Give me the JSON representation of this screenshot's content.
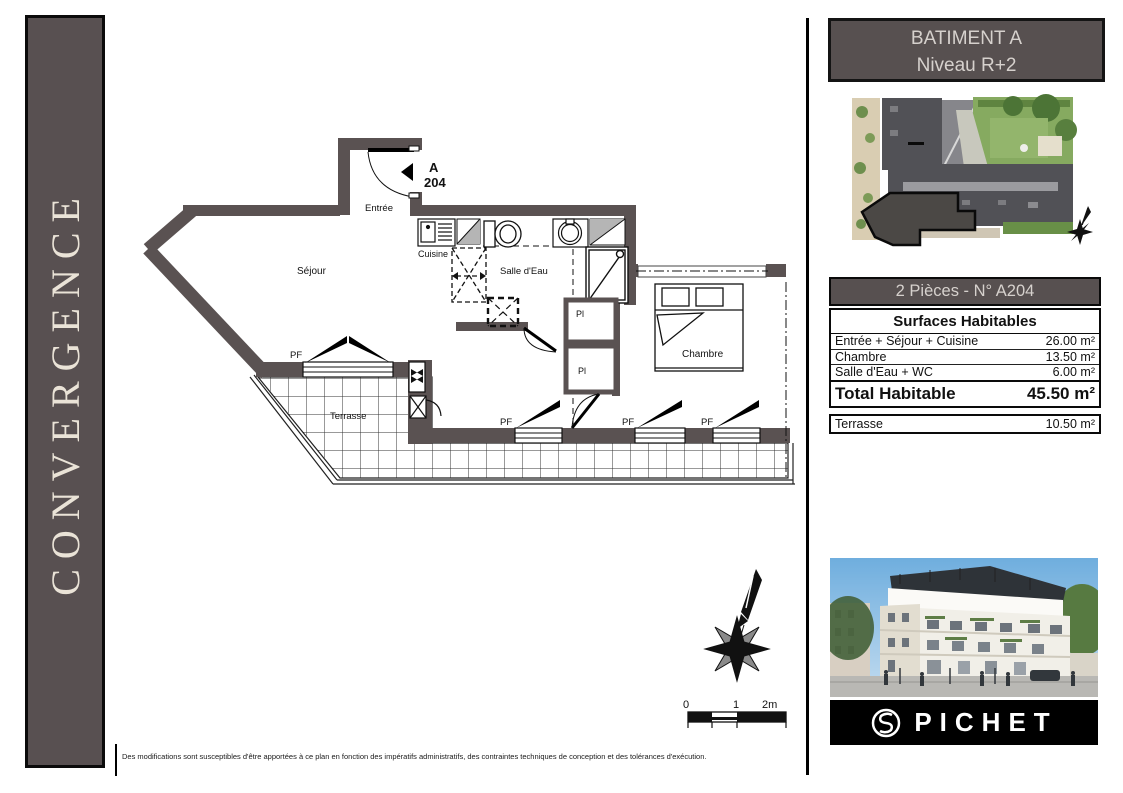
{
  "banner": {
    "project": "CONVERGENCE"
  },
  "header": {
    "line1": "BATIMENT A",
    "line2": "Niveau R+2"
  },
  "unit_table": {
    "title": "2 Pièces - N° A204",
    "subtitle": "Surfaces Habitables",
    "rows": [
      {
        "label": "Entrée + Séjour + Cuisine",
        "value": "26.00 m²"
      },
      {
        "label": "Chambre",
        "value": "13.50 m²"
      },
      {
        "label": "Salle d'Eau + WC",
        "value": "6.00 m²"
      }
    ],
    "total": {
      "label": "Total Habitable",
      "value": "45.50 m²"
    },
    "terrace": {
      "label": "Terrasse",
      "value": "10.50 m²"
    }
  },
  "floor_plan": {
    "unit_marker": {
      "line1": "A",
      "line2": "204"
    },
    "rooms": {
      "entree": "Entrée",
      "cuisine": "Cuisine",
      "salle_eau": "Salle d'Eau",
      "sejour": "Séjour",
      "chambre": "Chambre",
      "terrasse": "Terrasse"
    },
    "window_label": "PF",
    "closet_label": "Pl"
  },
  "scale_bar": {
    "t0": "0",
    "t1": "1",
    "t2": "2m"
  },
  "logo": {
    "brand": "PICHET"
  },
  "footer": {
    "disclaimer": "Des modifications sont susceptibles d'être apportées à ce plan en fonction des impératifs administratifs, des contraintes techniques de conception et des tolérances d'exécution."
  },
  "colors": {
    "wall": "#5a5252",
    "panel": "#575050",
    "banner_text": "#eae3d7"
  }
}
